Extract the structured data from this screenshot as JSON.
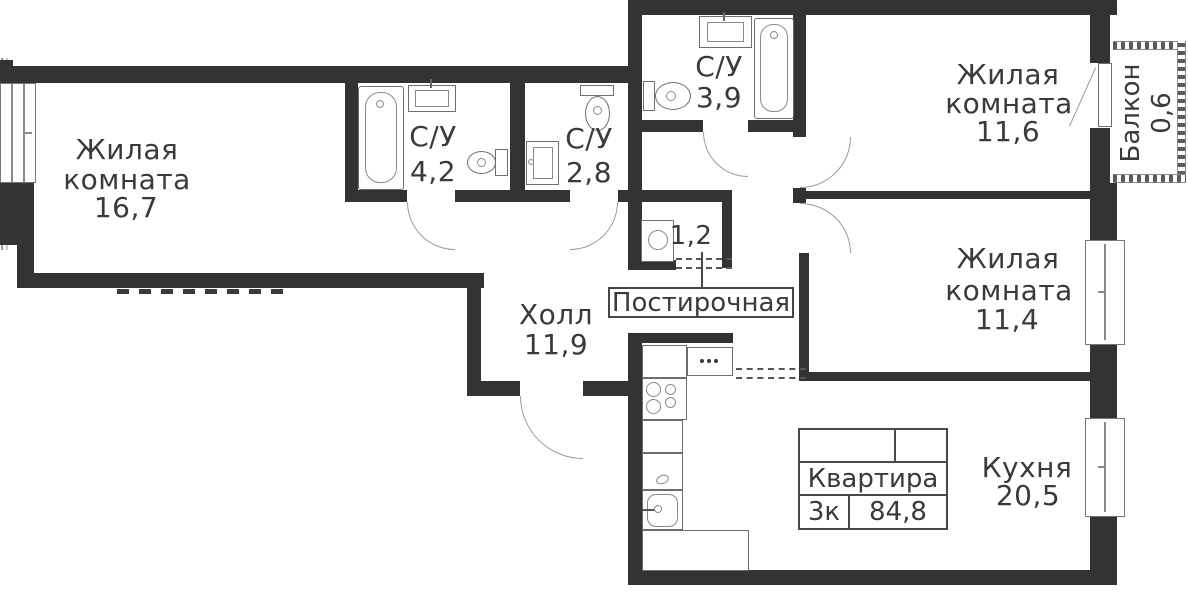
{
  "rooms": {
    "living1": {
      "line1": "Жилая",
      "line2": "комната",
      "area": "16,7"
    },
    "bath1": {
      "name": "С/У",
      "area": "4,2"
    },
    "bath2": {
      "name": "С/У",
      "area": "2,8"
    },
    "bath3": {
      "name": "С/У",
      "area": "3,9"
    },
    "living2": {
      "line1": "Жилая",
      "line2": "комната",
      "area": "11,6"
    },
    "living3": {
      "line1": "Жилая",
      "line2": "комната",
      "area": "11,4"
    },
    "hall": {
      "name": "Холл",
      "area": "11,9"
    },
    "laundry": {
      "area": "1,2",
      "callout": "Постирочная"
    },
    "kitchen": {
      "name": "Кухня",
      "area": "20,5"
    },
    "balcony": {
      "name": "Балкон",
      "area": "0,6"
    }
  },
  "info_box": {
    "title": "Квартира",
    "rooms_count": "3к",
    "total_area": "84,8"
  },
  "fixtures": {
    "bath1": [
      "bathtub",
      "sink",
      "toilet"
    ],
    "bath2": [
      "toilet",
      "sink"
    ],
    "bath3": [
      "toilet",
      "sink",
      "bathtub"
    ],
    "laundry": [
      "washing-machine"
    ],
    "kitchen": [
      "counter",
      "hood-cabinet",
      "stove",
      "counter",
      "counter",
      "sink",
      "counter"
    ]
  },
  "colors": {
    "wall": "#333333",
    "text": "#3a3a3a",
    "fixture_outline": "#6e6e6e"
  }
}
